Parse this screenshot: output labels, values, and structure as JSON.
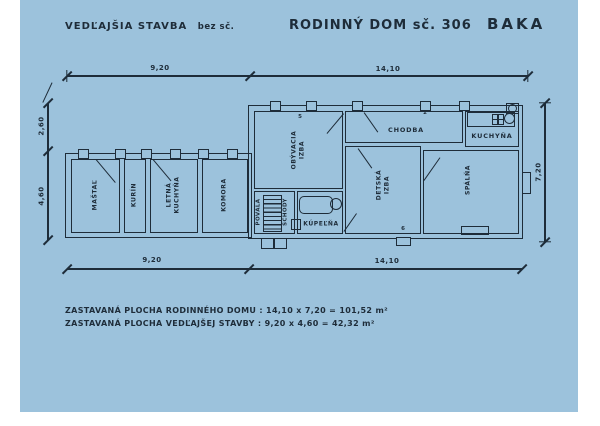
{
  "document": {
    "titles": {
      "outbuilding": "VEDĽAJŠIA STAVBA",
      "outbuilding_suffix": "bez sč.",
      "house": "RODINNÝ DOM sč. 306",
      "locality": "BAKA"
    },
    "rooms": {
      "mastal": "MAŠTAĽ",
      "kurin": "KURÍN",
      "letna_l1": "LETNÁ",
      "letna_l2": "KUCHYŇA",
      "komora": "KOMORA",
      "obyvacia_l1": "OBÝVACIA",
      "obyvacia_l2": "IZBA",
      "chodba": "CHODBA",
      "kuchyna": "KUCHYŇA",
      "detska_l1": "DETSKÁ",
      "detska_l2": "IZBA",
      "spalna": "SPÁLŇA",
      "kupelna": "KÚPEĽŇA",
      "povala": "POVALA",
      "schody": "SCHODY"
    },
    "dimensions": {
      "top_left": "9,20",
      "top_right": "14,10",
      "bottom_left": "9,20",
      "bottom_right": "14,10",
      "left_upper": "2,60",
      "left_lower": "4,60",
      "right": "7,20"
    },
    "window_tags": {
      "tag5": "5",
      "tag2": "2",
      "tag6": "6"
    },
    "notes": {
      "line1": "ZASTAVANÁ PLOCHA RODINNÉHO DOMU : 14,10 x 7,20 =  101,52 m²",
      "line2": "ZASTAVANÁ PLOCHA VEDĽAJŠEJ STAVBY : 9,20 x 4,60 =  42,32 m²"
    },
    "colors": {
      "paper": "#9cc2dc",
      "ink": "#1e2c39",
      "margin": "#ffffff"
    }
  }
}
